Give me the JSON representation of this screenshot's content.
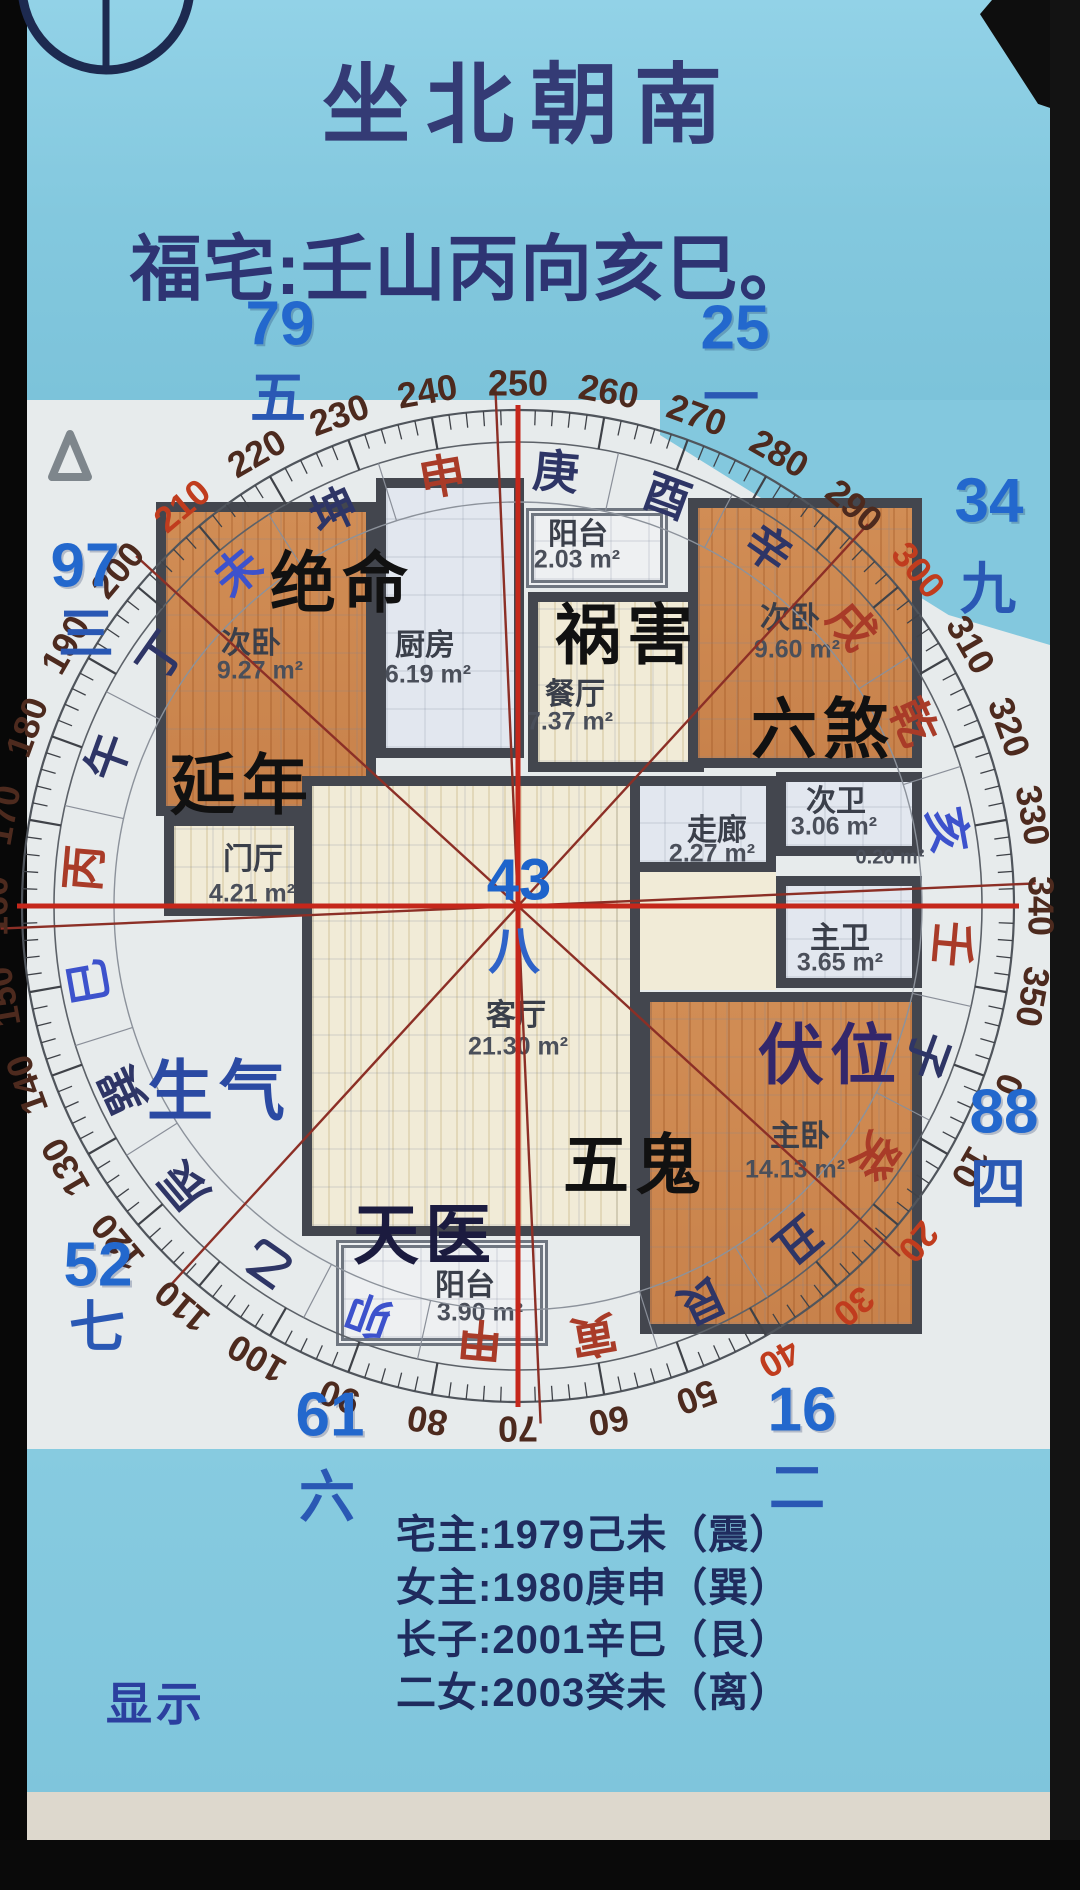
{
  "header": {
    "title": "坐北朝南",
    "subtitle": "福宅:壬山丙向亥巳。"
  },
  "compass": {
    "center_value": "43",
    "center_trigram": "八",
    "center": {
      "x": 518,
      "y": 906
    },
    "top_bearing": 250,
    "degree_labels": [
      0,
      10,
      20,
      30,
      40,
      50,
      60,
      70,
      80,
      90,
      100,
      110,
      120,
      130,
      140,
      150,
      160,
      170,
      180,
      190,
      200,
      210,
      220,
      230,
      240,
      250,
      260,
      270,
      280,
      290,
      300,
      310,
      320,
      330,
      340,
      350
    ],
    "red_degree_labels": [
      20,
      30,
      40,
      210,
      300
    ],
    "mountains": [
      {
        "char": "子",
        "color": "navy"
      },
      {
        "char": "癸",
        "color": "red"
      },
      {
        "char": "丑",
        "color": "navy"
      },
      {
        "char": "艮",
        "color": "navy"
      },
      {
        "char": "寅",
        "color": "red"
      },
      {
        "char": "甲",
        "color": "red"
      },
      {
        "char": "卯",
        "color": "blue"
      },
      {
        "char": "乙",
        "color": "navy"
      },
      {
        "char": "辰",
        "color": "navy"
      },
      {
        "char": "巽",
        "color": "navy"
      },
      {
        "char": "巳",
        "color": "blue"
      },
      {
        "char": "丙",
        "color": "red"
      },
      {
        "char": "午",
        "color": "navy"
      },
      {
        "char": "丁",
        "color": "navy"
      },
      {
        "char": "未",
        "color": "blue"
      },
      {
        "char": "坤",
        "color": "navy"
      },
      {
        "char": "申",
        "color": "red"
      },
      {
        "char": "庚",
        "color": "navy"
      },
      {
        "char": "酉",
        "color": "navy"
      },
      {
        "char": "辛",
        "color": "navy"
      },
      {
        "char": "戌",
        "color": "red"
      },
      {
        "char": "乾",
        "color": "red"
      },
      {
        "char": "亥",
        "color": "blue"
      },
      {
        "char": "壬",
        "color": "red"
      }
    ],
    "trigram_line_bearings": [
      22.5,
      67.5,
      112.5,
      157.5,
      202.5,
      247.5,
      292.5,
      337.5
    ],
    "colors": {
      "navy": "#2e3566",
      "red": "#a93b28",
      "blue": "#3d52cc",
      "degree_dark": "#4d2a1e",
      "degree_red": "#c03c1e",
      "needle": "#c5271b",
      "trigram_line": "#8c2f26"
    }
  },
  "flying_stars": [
    {
      "value": "79",
      "trigram": "五",
      "nx": 280,
      "ny": 324,
      "tx": 278,
      "ty": 394
    },
    {
      "value": "25",
      "trigram": "一",
      "nx": 735,
      "ny": 328,
      "tx": 731,
      "ty": 394
    },
    {
      "value": "34",
      "trigram": "九",
      "nx": 989,
      "ny": 501,
      "tx": 988,
      "ty": 585
    },
    {
      "value": "97",
      "trigram": "三",
      "nx": 85,
      "ny": 566,
      "tx": 86,
      "ty": 630
    },
    {
      "value": "88",
      "trigram": "四",
      "nx": 1004,
      "ny": 1112,
      "tx": 998,
      "ty": 1180
    },
    {
      "value": "52",
      "trigram": "七",
      "nx": 98,
      "ny": 1265,
      "tx": 97,
      "ty": 1323
    },
    {
      "value": "61",
      "trigram": "六",
      "nx": 330,
      "ny": 1415,
      "tx": 327,
      "ty": 1493
    },
    {
      "value": "16",
      "trigram": "二",
      "nx": 802,
      "ny": 1410,
      "tx": 797,
      "ty": 1484
    }
  ],
  "bazhai_stars": [
    {
      "text": "绝命",
      "x": 342,
      "y": 578,
      "color": "#111111"
    },
    {
      "text": "祸害",
      "x": 627,
      "y": 630,
      "color": "#111111"
    },
    {
      "text": "六煞",
      "x": 823,
      "y": 724,
      "color": "#111111"
    },
    {
      "text": "延年",
      "x": 242,
      "y": 780,
      "color": "#111111"
    },
    {
      "text": "伏位",
      "x": 830,
      "y": 1050,
      "color": "#33276b"
    },
    {
      "text": "生气",
      "x": 219,
      "y": 1086,
      "color": "#2b4aa3"
    },
    {
      "text": "五鬼",
      "x": 635,
      "y": 1160,
      "color": "#111111"
    },
    {
      "text": "天医",
      "x": 425,
      "y": 1230,
      "color": "#1b1b3f"
    }
  ],
  "floor_plan": {
    "rooms": [
      {
        "id": "bedroom-left",
        "name": "次卧",
        "area": "9.27 m²",
        "x": 156,
        "y": 502,
        "w": 220,
        "h": 314,
        "floor": "orange",
        "lx": 251,
        "ly": 640,
        "ax": 260,
        "ay": 671
      },
      {
        "id": "kitchen",
        "name": "厨房",
        "area": "6.19 m²",
        "x": 376,
        "y": 478,
        "w": 148,
        "h": 280,
        "floor": "pale",
        "lx": 425,
        "ly": 642,
        "ax": 428,
        "ay": 675
      },
      {
        "id": "balcony-top",
        "name": "阳台",
        "area": "2.03 m²",
        "x": 526,
        "y": 508,
        "w": 142,
        "h": 80,
        "floor": "white",
        "balcony": true,
        "lx": 578,
        "ly": 531,
        "ax": 577,
        "ay": 560
      },
      {
        "id": "dining",
        "name": "餐厅",
        "area": "7.37 m²",
        "x": 528,
        "y": 592,
        "w": 176,
        "h": 180,
        "floor": "cream",
        "lx": 575,
        "ly": 691,
        "ax": 570,
        "ay": 722
      },
      {
        "id": "bedroom-right",
        "name": "次卧",
        "area": "9.60 m²",
        "x": 688,
        "y": 498,
        "w": 234,
        "h": 270,
        "floor": "orange",
        "lx": 790,
        "ly": 615,
        "ax": 797,
        "ay": 650
      },
      {
        "id": "corridor",
        "name": "走廊",
        "area": "2.27 m²",
        "x": 616,
        "y": 776,
        "w": 160,
        "h": 96,
        "floor": "pale",
        "lx": 717,
        "ly": 827,
        "ax": 712,
        "ay": 854
      },
      {
        "id": "bath-second",
        "name": "次卫",
        "area": "3.06 m²",
        "x": 776,
        "y": 772,
        "w": 146,
        "h": 84,
        "floor": "pale",
        "lx": 836,
        "ly": 798,
        "ax": 834,
        "ay": 827
      },
      {
        "id": "bath-master",
        "name": "主卫",
        "area": "3.65 m²",
        "x": 776,
        "y": 876,
        "w": 146,
        "h": 112,
        "floor": "pale",
        "lx": 840,
        "ly": 935,
        "ax": 840,
        "ay": 963
      },
      {
        "id": "bedroom-master",
        "name": "主卧",
        "area": "14.13 m²",
        "x": 640,
        "y": 992,
        "w": 282,
        "h": 342,
        "floor": "orange",
        "lx": 800,
        "ly": 1133,
        "ax": 795,
        "ay": 1170
      },
      {
        "id": "living",
        "name": "客厅",
        "area": "21.30 m²",
        "x": 302,
        "y": 776,
        "w": 338,
        "h": 460,
        "floor": "cream",
        "lx": 516,
        "ly": 1012,
        "ax": 518,
        "ay": 1047
      },
      {
        "id": "foyer",
        "name": "门厅",
        "area": "4.21 m²",
        "x": 164,
        "y": 816,
        "w": 140,
        "h": 100,
        "floor": "cream",
        "lx": 253,
        "ly": 856,
        "ax": 252,
        "ay": 894
      },
      {
        "id": "balcony-bottom",
        "name": "阳台",
        "area": "3.90 m²",
        "x": 336,
        "y": 1240,
        "w": 212,
        "h": 106,
        "floor": "white",
        "balcony": true,
        "lx": 465,
        "ly": 1282,
        "ax": 480,
        "ay": 1313
      }
    ],
    "hall_patch": {
      "x": 616,
      "y": 872,
      "w": 160,
      "h": 118
    },
    "tiny_area_label": {
      "text": "0.20 m²",
      "x": 890,
      "y": 858
    }
  },
  "footer": {
    "residents": [
      "宅主:1979己未（震）",
      "女主:1980庚申（巽）",
      "长子:2001辛巳（艮）",
      "二女:2003癸未（离）"
    ],
    "display_button": "显示"
  }
}
